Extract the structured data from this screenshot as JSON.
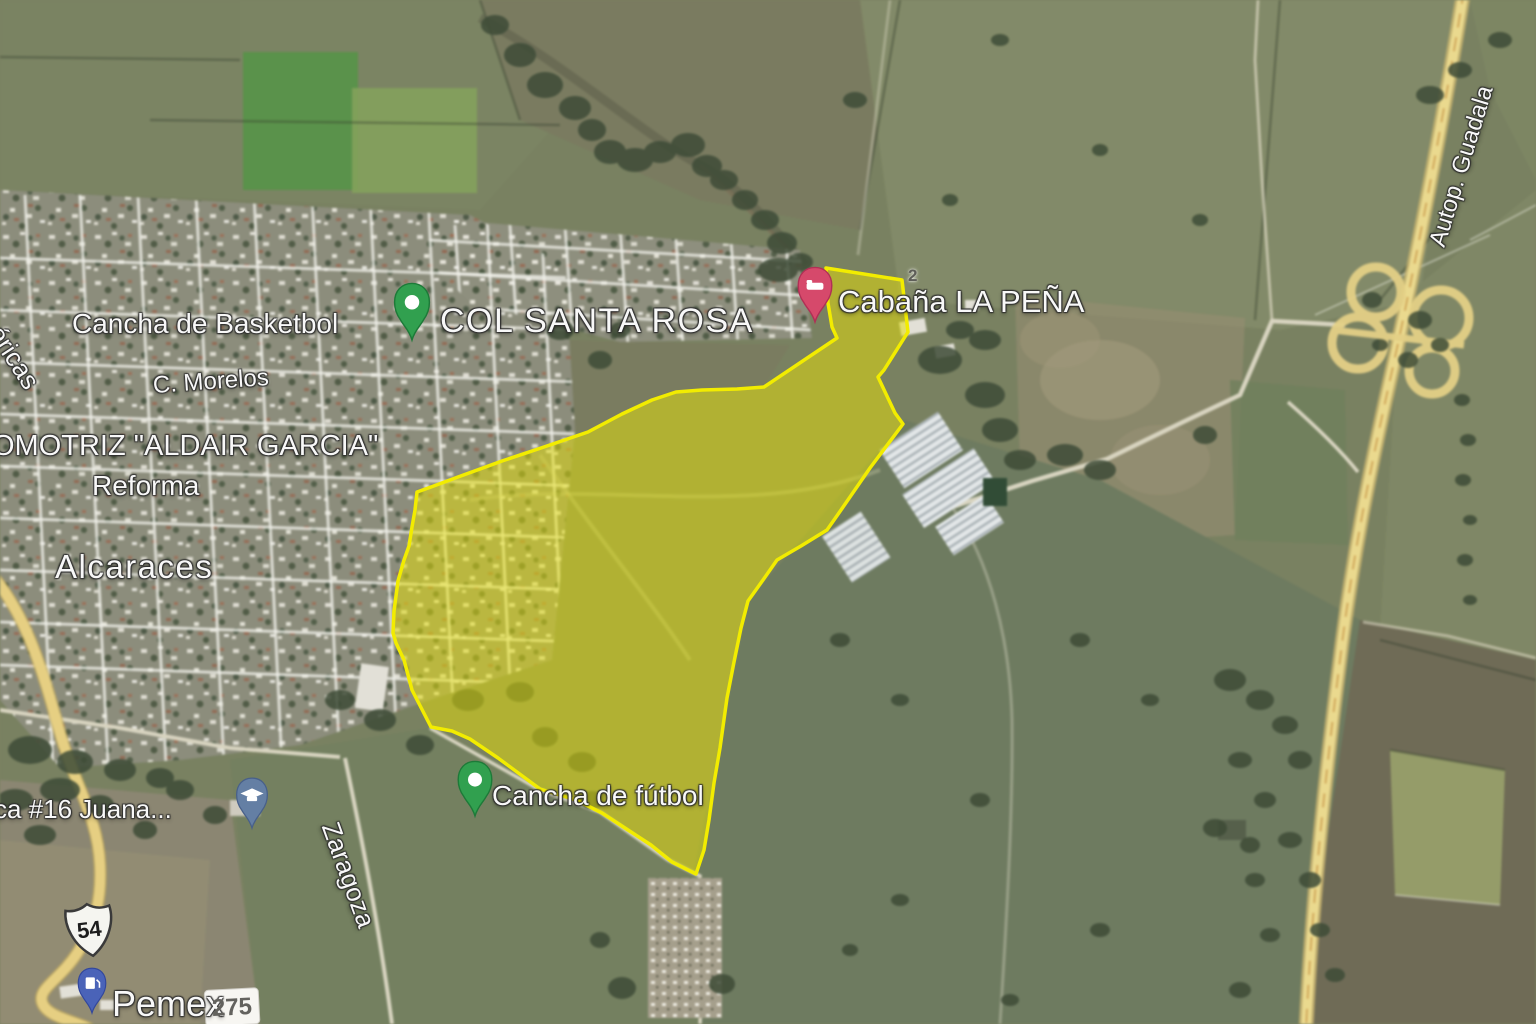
{
  "map": {
    "labels": {
      "cancha_basketbol": "Cancha de Basketbol",
      "col_santa_rosa": "COL SANTA ROSA",
      "cabana_la_pena": "Cabaña LA PEÑA",
      "small_marker": "2",
      "calle_morelos": "C. Morelos",
      "automotriz_aldair_garcia": "OMOTRIZ \"ALDAIR GARCIA\"",
      "reforma": "Reforma",
      "alcaraces": "Alcaraces",
      "americas_partial": "éricas",
      "escuela_juana": "ca #16 Juana...",
      "cancha_futbol": "Cancha de fútbol",
      "zaragoza": "Zaragoza",
      "pemex": "Pemex",
      "autopista": "Autop. Guadala",
      "route_54": "54",
      "route_275": "275"
    },
    "colors": {
      "parcel_fill": "#e4de0a",
      "parcel_stroke": "#f2ec00",
      "highway_yellow": "#ecd988",
      "pin_green": "#31a04f",
      "pin_pink": "#d6496b",
      "pin_blue": "#4a63b8",
      "pin_slate": "#647fa4"
    }
  }
}
